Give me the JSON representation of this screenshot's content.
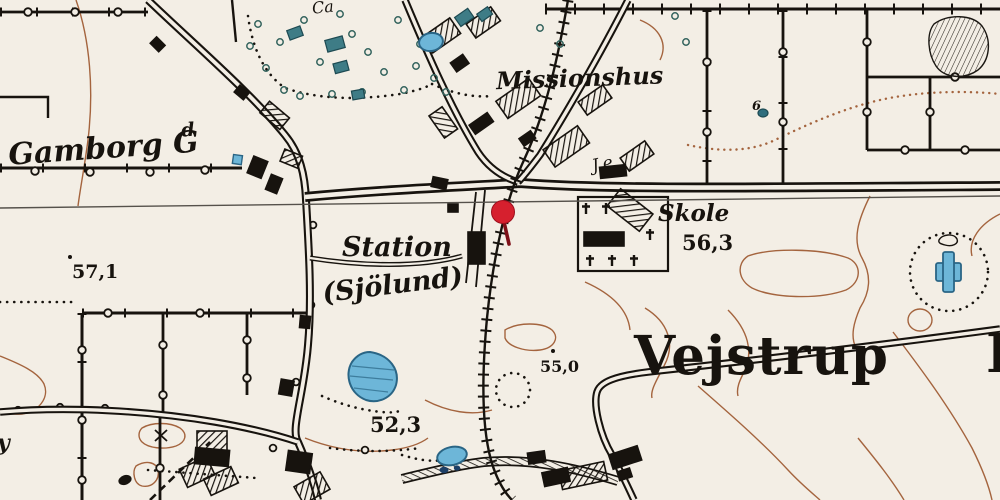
{
  "map": {
    "description": "Historical Danish topographic map extract with location marker",
    "labels": {
      "gamborg_main": "Gamborg G",
      "gamborg_sup": "d",
      "missionshus": "Missionshus",
      "station": "Station",
      "sjolund": "(Sjölund)",
      "skole": "Skole",
      "vejstrup": "Vejstrup",
      "vejstrup_partial": "B",
      "je": "J.e",
      "ca": "Ca",
      "parcel_six": "6",
      "partial_y": "y"
    },
    "elevations": {
      "e571": "57,1",
      "e563": "56,3",
      "e550": "55,0",
      "e523": "52,3"
    },
    "marker": {
      "name": "location-pin",
      "color": "#d6202e"
    },
    "colors": {
      "paper": "#f3eee5",
      "ink": "#17130e",
      "water": "#6db6d8",
      "water_outline": "#2a6585",
      "contour": "#a4643e",
      "pin": "#d6202e",
      "pin_stem": "#7e1018",
      "vegetation": "#3e7c86",
      "neatline": "#55514b"
    }
  }
}
